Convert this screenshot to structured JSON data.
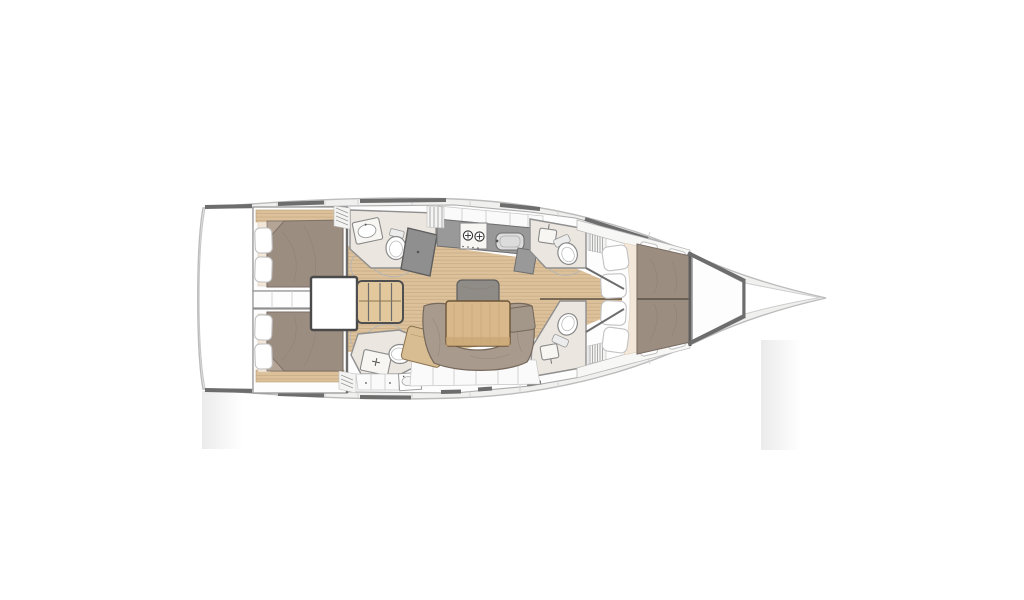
{
  "diagram": {
    "kind": "sailboat-interior-floor-plan",
    "orientation": "bow-right",
    "rooms": [
      "aft-port-cabin",
      "aft-starboard-cabin",
      "engine-compartment",
      "companionway",
      "aft-port-head",
      "aft-starboard-head",
      "galley",
      "salon",
      "forward-port-head",
      "forward-starboard-head",
      "forward-cabin",
      "anchor-locker"
    ],
    "features": {
      "stove-icon": "two circles with cross marks (burners)",
      "sink-icon": "rounded basin rectangle",
      "toilet-icon": "oval bowl with tank",
      "steps-icon": "ladder with four treads",
      "bed-icon": "upholstered mattress with pillows",
      "table-icon": "wood plank table",
      "hatch-icon": "hatched parallelogram"
    }
  },
  "palette": {
    "background": "#ffffff",
    "deck_fill": "#f0f0ef",
    "hull_stroke": "#bcbcbc",
    "wall_stroke": "#8f8f8f",
    "trim_dark": "#6d6d6d",
    "room_fill": "#fdfdfd",
    "head_fill": "#ebe6e0",
    "wood_fill": "#dcc19b",
    "wood_line": "#c2a67e",
    "wood_seam": "#6f5f4c",
    "steps_fill": "#e3c89d",
    "bed_fill": "#9c8d81",
    "bed_stroke": "#7c7067",
    "cream_fill": "#f2e7d9",
    "pillow_fill": "#ffffff",
    "pillow_stroke": "#c2c2c2",
    "counter_fill": "#999999",
    "counter_stroke": "#6f6f6f",
    "fixture_fill": "#f8f6f3",
    "fixture_stroke": "#8a8a8a",
    "upholstery_fill": "#a89a8c",
    "upholstery_stroke": "#75685c",
    "table_fill": "#d9b98c",
    "table_stroke": "#6b5638",
    "seatback_fill": "#8f8b86",
    "engine_stroke": "#4a4a4a",
    "fade_band": "#ebebeb"
  }
}
